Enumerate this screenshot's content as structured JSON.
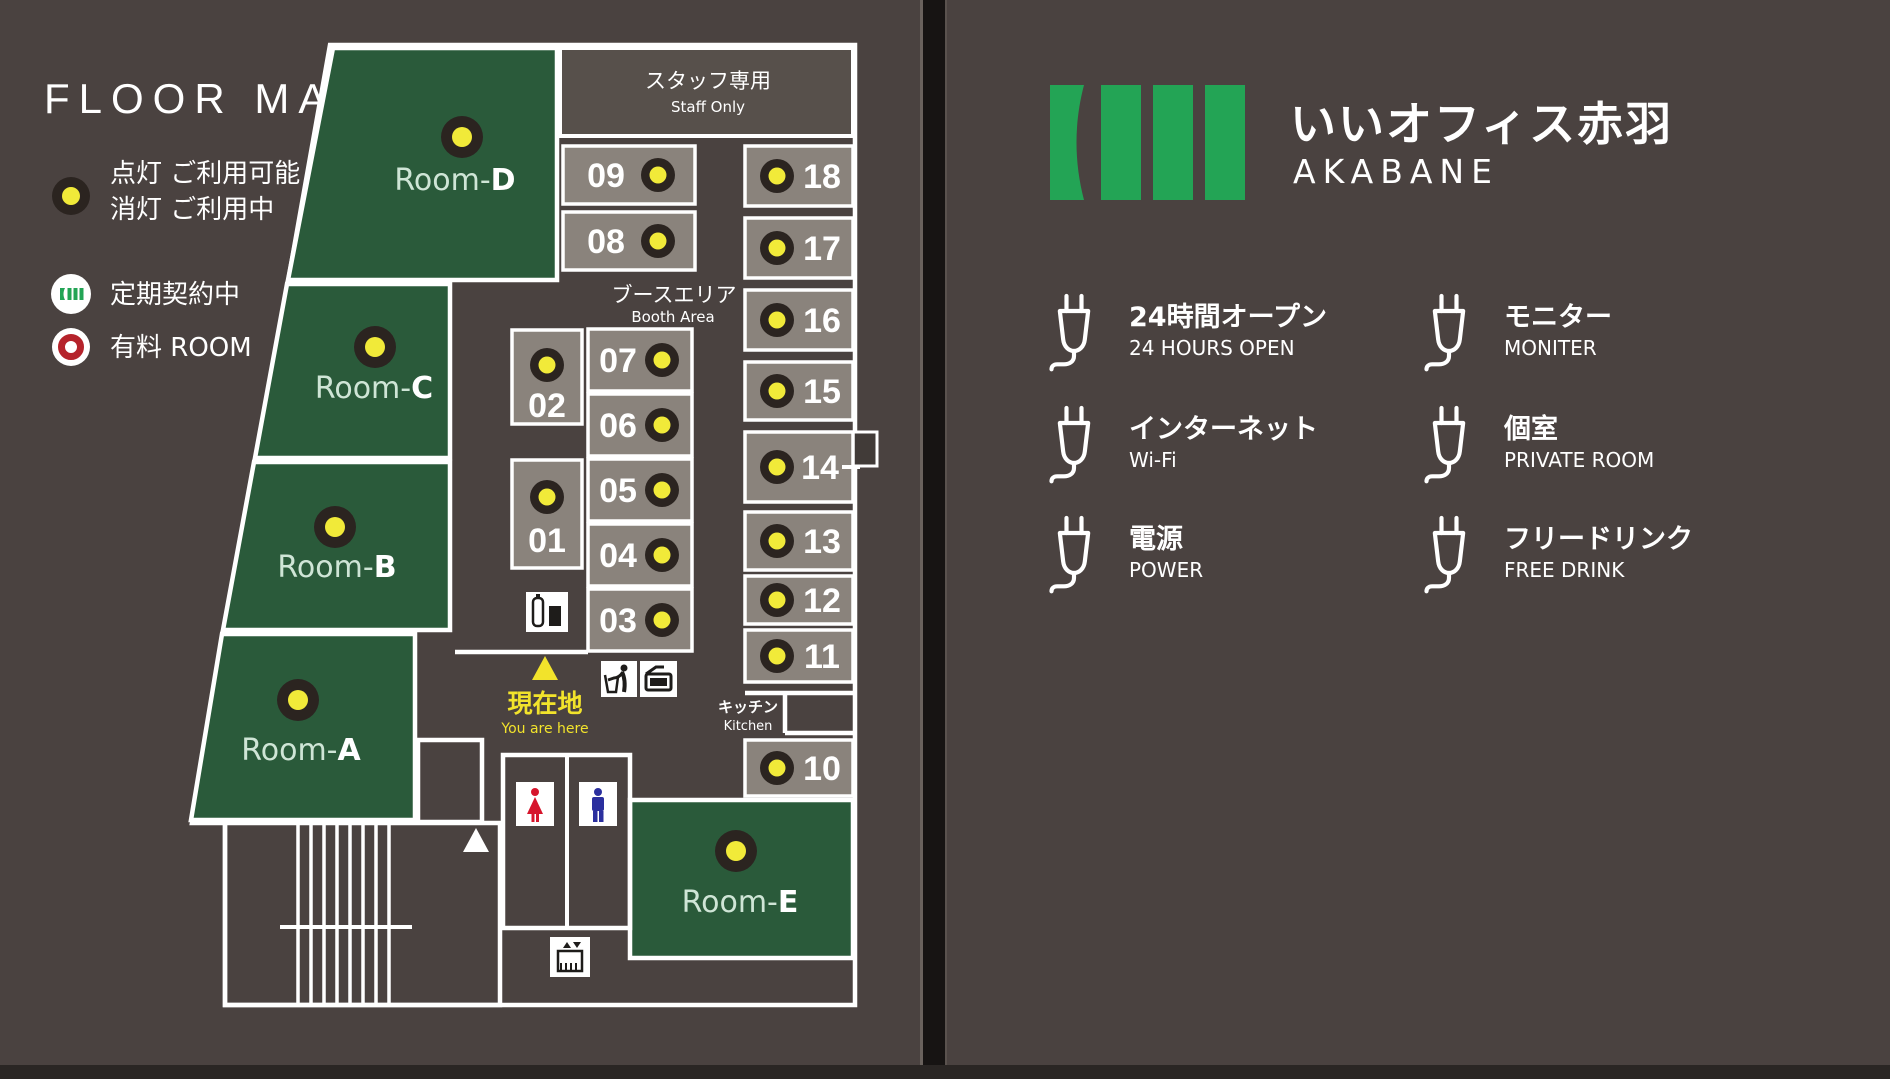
{
  "colors": {
    "background": "#4a4240",
    "room_green": "#2a5a3a",
    "booth_gray": "#8a837c",
    "lamp_yellow": "#f1ea39",
    "location_yellow": "#f2e32b",
    "brand_green": "#23a455",
    "charged_red": "#b5232b",
    "toilet_woman_red": "#d6152c",
    "toilet_man_blue": "#2b2f9e"
  },
  "left_panel": {
    "title": "FLOOR MAP",
    "legend": {
      "lamp_line1": "点灯 ご利用可能",
      "lamp_line2": "消灯 ご利用中",
      "contract": "定期契約中",
      "charged": "有料 ROOM"
    },
    "map": {
      "staff_jp": "スタッフ専用",
      "staff_en": "Staff Only",
      "booth_area_jp": "ブースエリア",
      "booth_area_en": "Booth Area",
      "kitchen_jp": "キッチン",
      "kitchen_en": "Kitchen",
      "location_jp": "現在地",
      "location_en": "You are here",
      "rooms": [
        {
          "prefix": "Room-",
          "letter": "D"
        },
        {
          "prefix": "Room-",
          "letter": "C"
        },
        {
          "prefix": "Room-",
          "letter": "B"
        },
        {
          "prefix": "Room-",
          "letter": "A"
        },
        {
          "prefix": "Room-",
          "letter": "E"
        }
      ],
      "booth_numbers": [
        "01",
        "02",
        "03",
        "04",
        "05",
        "06",
        "07",
        "08",
        "09",
        "10",
        "11",
        "12",
        "13",
        "14",
        "15",
        "16",
        "17",
        "18"
      ]
    }
  },
  "right_panel": {
    "brand_jp": "いいオフィス赤羽",
    "brand_en": "AKABANE",
    "amenities": [
      {
        "jp": "24時間オープン",
        "en": "24 HOURS OPEN"
      },
      {
        "jp": "インターネット",
        "en": "Wi-Fi"
      },
      {
        "jp": "電源",
        "en": "POWER"
      },
      {
        "jp": "モニター",
        "en": "MONITER"
      },
      {
        "jp": "個室",
        "en": "PRIVATE ROOM"
      },
      {
        "jp": "フリードリンク",
        "en": "FREE DRINK"
      }
    ]
  }
}
